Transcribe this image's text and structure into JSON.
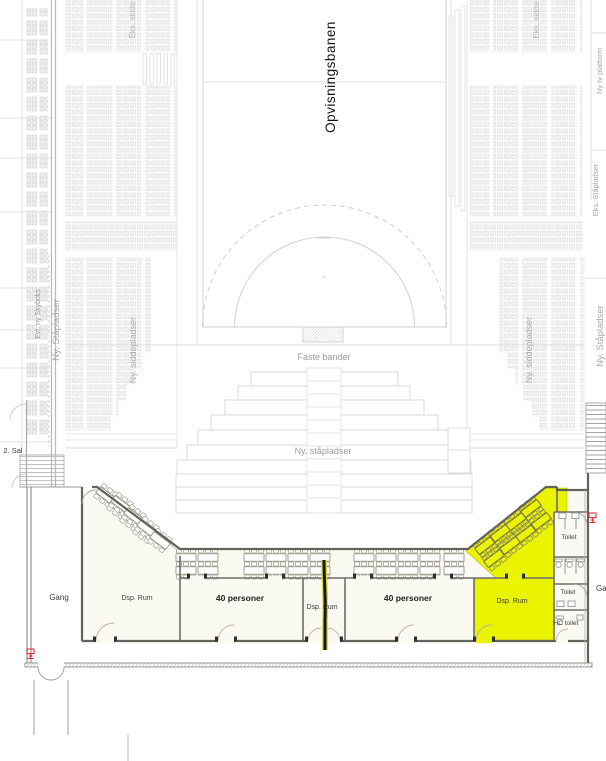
{
  "plan": {
    "field_label": "Opvisningsbanen",
    "boards_label": "Faste bander",
    "standing_center_label": "Ny. ståpladser",
    "second_floor_label": "2. Sal"
  },
  "stands": {
    "left_existing_seats": "Eks. sidde",
    "right_existing_seats": "Eks. sidde",
    "left_new_seats": "Ny. siddepladser",
    "right_new_seats": "Ny. siddepladser",
    "left_new_standing": "Ny. Ståpladser",
    "right_new_standing": "Ny. Ståpladser",
    "skybox": "Evt. ny Skyboks",
    "tv_platform": "Ny tv platform",
    "right_existing_standing": "Eks. Ståpladser"
  },
  "rooms": {
    "corridor_left": "Gang",
    "storage_left": "Dsp. Rum",
    "meeting_1": "40 personer",
    "storage_mid": "Dsp. Rum",
    "meeting_2": "40 personer",
    "storage_right": "Dsp. Rum",
    "toilet_upper": "Toilet",
    "toilet_lower": "Toilet",
    "hc_toilet": "HC toilet",
    "corridor_right": "Ga"
  },
  "colors": {
    "highlight_yellow": "#eaf300",
    "accent_red": "#e03434",
    "wall_gray": "#63635b",
    "light_line": "#d9d9d9",
    "label_gray": "#9e9e9e",
    "dark_text": "#1f1f1f",
    "room_fill": "#fbfaf2"
  }
}
